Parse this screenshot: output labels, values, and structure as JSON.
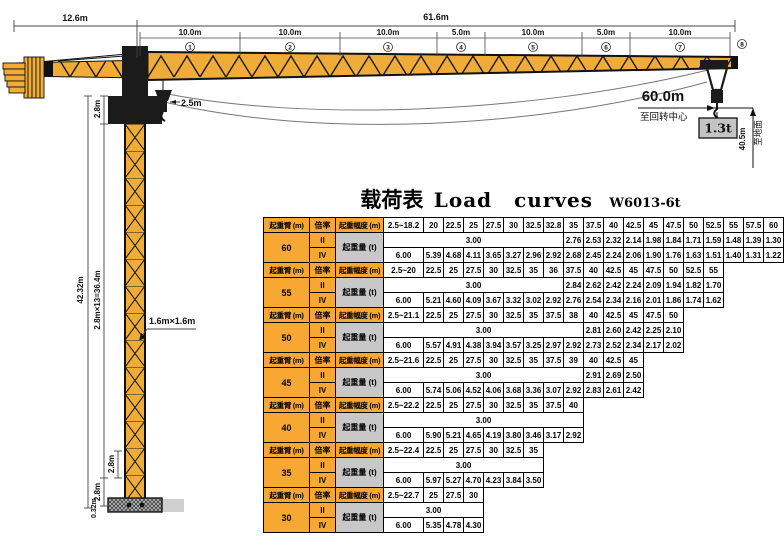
{
  "title": {
    "cn": "载荷表",
    "en": "Load curves",
    "model": "W6013-6t"
  },
  "diagram": {
    "counter_jib_dim": "12.6m",
    "jib_dim": "61.6m",
    "segments": [
      {
        "len": "10.0m",
        "num": "1"
      },
      {
        "len": "10.0m",
        "num": "2"
      },
      {
        "len": "10.0m",
        "num": "3"
      },
      {
        "len": "5.0m",
        "num": "4"
      },
      {
        "len": "10.0m",
        "num": "5"
      },
      {
        "len": "5.0m",
        "num": "6"
      },
      {
        "len": "10.0m",
        "num": "7"
      },
      {
        "len": "",
        "num": "8"
      }
    ],
    "tower_hook_offset": "2.5m",
    "top_section_height": "2.8m",
    "tower_total_height": "42.32m",
    "tower_sections": "2.8m×13=36.4m",
    "section_height_a": "2.8m",
    "section_height_b": "2.8m",
    "base_height": "0.32m",
    "tower_cross_section": "1.6m×1.6m",
    "max_radius": "60.0m",
    "to_slew_center": "至回转中心",
    "tip_load": "1.3t",
    "hook_height": "40.5m",
    "to_ground": "至地面"
  },
  "load_table": {
    "headers": {
      "boom": "起重臂 (m)",
      "ratio": "倍率",
      "radius": "起重幅度 (m)",
      "capacity": "起重量 (t)",
      "ratio_ii": "II",
      "ratio_iv": "IV"
    },
    "sections": [
      {
        "boom": "60",
        "span": 8,
        "radii": [
          "2.5~18.2",
          "20",
          "22.5",
          "25",
          "27.5",
          "30",
          "32.5",
          "32.8",
          "35",
          "37.5",
          "40",
          "42.5",
          "45",
          "47.5",
          "50",
          "52.5",
          "55",
          "57.5",
          "60"
        ],
        "flat": "3.00",
        "ii": [
          "2.76",
          "2.53",
          "2.32",
          "2.14",
          "1.98",
          "1.84",
          "1.71",
          "1.59",
          "1.48",
          "1.39",
          "1.30"
        ],
        "iv": [
          "6.00",
          "5.39",
          "4.68",
          "4.11",
          "3.65",
          "3.27",
          "2.96",
          "2.92",
          "2.68",
          "2.45",
          "2.24",
          "2.06",
          "1.90",
          "1.76",
          "1.63",
          "1.51",
          "1.40",
          "1.31",
          "1.22"
        ]
      },
      {
        "boom": "55",
        "span": 8,
        "radii": [
          "2.5~20",
          "22.5",
          "25",
          "27.5",
          "30",
          "32.5",
          "35",
          "36",
          "37.5",
          "40",
          "42.5",
          "45",
          "47.5",
          "50",
          "52.5",
          "55"
        ],
        "flat": "3.00",
        "ii": [
          "2.84",
          "2.62",
          "2.42",
          "2.24",
          "2.09",
          "1.94",
          "1.82",
          "1.70"
        ],
        "iv": [
          "6.00",
          "5.21",
          "4.60",
          "4.09",
          "3.67",
          "3.32",
          "3.02",
          "2.92",
          "2.76",
          "2.54",
          "2.34",
          "2.16",
          "2.01",
          "1.86",
          "1.74",
          "1.62"
        ]
      },
      {
        "boom": "50",
        "span": 9,
        "radii": [
          "2.5~21.1",
          "22.5",
          "25",
          "27.5",
          "30",
          "32.5",
          "35",
          "37.5",
          "38",
          "40",
          "42.5",
          "45",
          "47.5",
          "50"
        ],
        "flat": "3.00",
        "ii": [
          "2.81",
          "2.60",
          "2.42",
          "2.25",
          "2.10"
        ],
        "iv": [
          "6.00",
          "5.57",
          "4.91",
          "4.38",
          "3.94",
          "3.57",
          "3.25",
          "2.97",
          "2.92",
          "2.73",
          "2.52",
          "2.34",
          "2.17",
          "2.02"
        ]
      },
      {
        "boom": "45",
        "span": 9,
        "radii": [
          "2.5~21.6",
          "22.5",
          "25",
          "27.5",
          "30",
          "32.5",
          "35",
          "37.5",
          "39",
          "40",
          "42.5",
          "45"
        ],
        "flat": "3.00",
        "ii": [
          "2.91",
          "2.69",
          "2.50"
        ],
        "iv": [
          "6.00",
          "5.74",
          "5.06",
          "4.52",
          "4.06",
          "3.68",
          "3.36",
          "3.07",
          "2.92",
          "2.83",
          "2.61",
          "2.42"
        ]
      },
      {
        "boom": "40",
        "span": 9,
        "radii": [
          "2.5~22.2",
          "22.5",
          "25",
          "27.5",
          "30",
          "32.5",
          "35",
          "37.5",
          "40"
        ],
        "flat": "3.00",
        "ii": [],
        "iv": [
          "6.00",
          "5.90",
          "5.21",
          "4.65",
          "4.19",
          "3.80",
          "3.46",
          "3.17",
          "2.92"
        ]
      },
      {
        "boom": "35",
        "span": 7,
        "radii": [
          "2.5~22.4",
          "22.5",
          "25",
          "27.5",
          "30",
          "32.5",
          "35"
        ],
        "flat": "3.00",
        "ii": [],
        "iv": [
          "6.00",
          "5.97",
          "5.27",
          "4.70",
          "4.23",
          "3.84",
          "3.50"
        ]
      },
      {
        "boom": "30",
        "span": 4,
        "radii": [
          "2.5~22.7",
          "25",
          "27.5",
          "30"
        ],
        "flat": "3.00",
        "ii": [],
        "iv": [
          "6.00",
          "5.35",
          "4.78",
          "4.30"
        ]
      }
    ]
  },
  "colors": {
    "crane_yellow": "#EFAC38",
    "table_orange": "#F7A832",
    "cell_gray": "#C8C8C8",
    "box_gray": "#C4C4C4"
  }
}
